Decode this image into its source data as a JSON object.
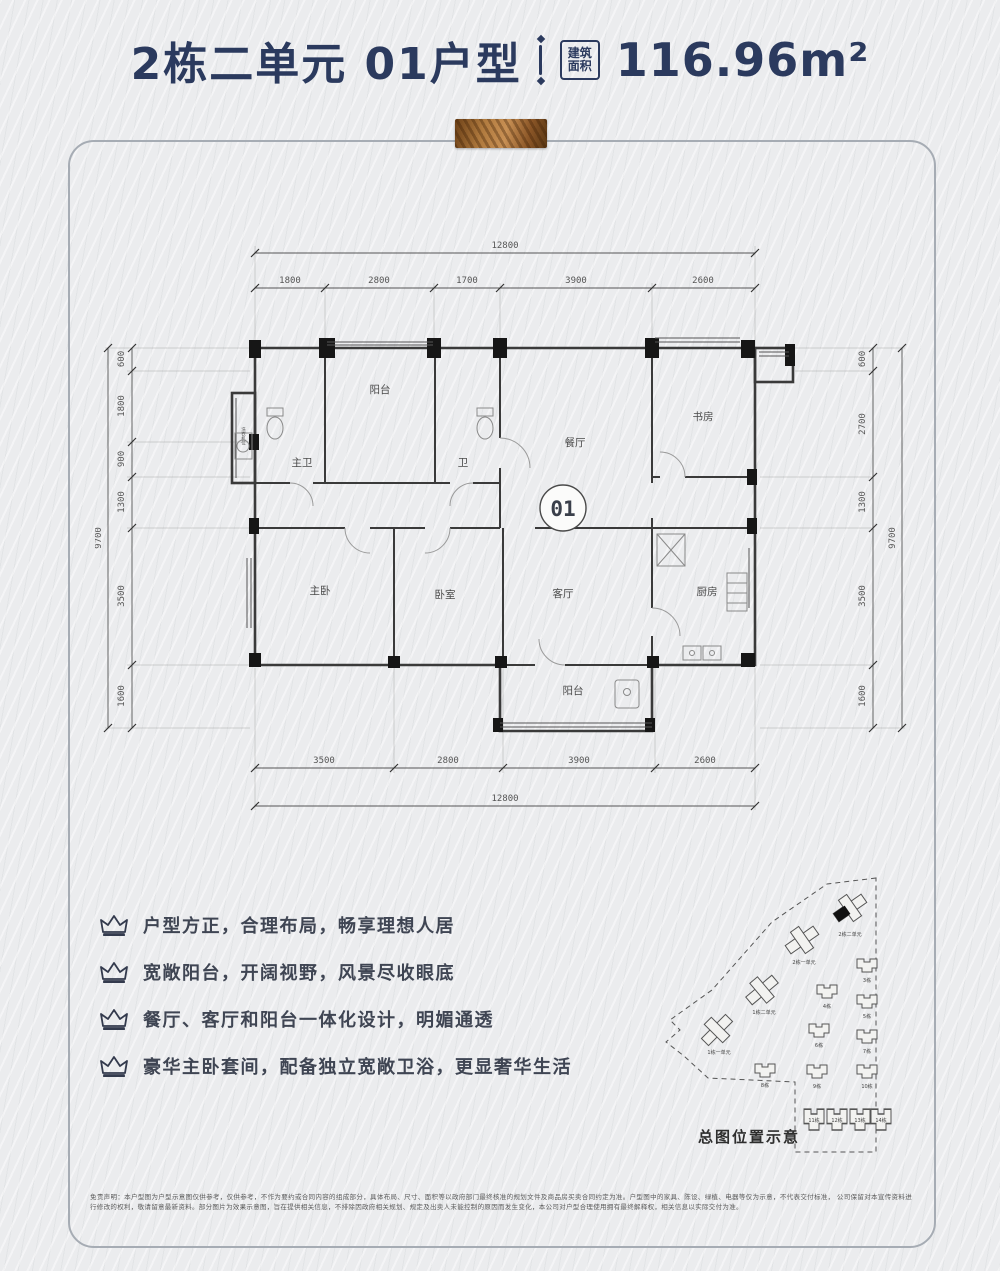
{
  "title": {
    "main": "2栋二单元 01户型",
    "area_badge_lines": [
      "建筑",
      "面积"
    ],
    "area_value": "116.96m²",
    "accent_color": "#2b3a5e"
  },
  "floorplan": {
    "unit_badge": "01",
    "rooms": {
      "balcony_top": "阳台",
      "master_bath": "主卫",
      "bath": "卫",
      "dining": "餐厅",
      "study": "书房",
      "master_bed": "主卧",
      "bedroom": "卧室",
      "living": "客厅",
      "kitchen": "厨房",
      "balcony_bottom": "阳台",
      "utility": "洗衣机位"
    },
    "dims": {
      "top": {
        "overall": "12800",
        "segments": [
          "1800",
          "2800",
          "1700",
          "3900",
          "2600"
        ]
      },
      "bottom": {
        "overall": "12800",
        "segments": [
          "3500",
          "2800",
          "3900",
          "2600"
        ]
      },
      "left": {
        "overall": "9700",
        "segments": [
          "600",
          "1800",
          "900",
          "1300",
          "3500",
          "1600"
        ]
      },
      "right": {
        "overall": "9700",
        "segments": [
          "600",
          "2700",
          "1300",
          "3500",
          "1600"
        ]
      }
    }
  },
  "features": [
    "户型方正，合理布局，畅享理想人居",
    "宽敞阳台，开阔视野，风景尽收眼底",
    "餐厅、客厅和阳台一体化设计，明媚通透",
    "豪华主卧套间，配备独立宽敞卫浴，更显奢华生活"
  ],
  "siteplan": {
    "caption": "总图位置示意",
    "buildings": [
      {
        "label": "2栋二单元",
        "highlight": true
      },
      {
        "label": "2栋一单元"
      },
      {
        "label": "1栋二单元"
      },
      {
        "label": "1栋一单元"
      },
      {
        "label": "3栋"
      },
      {
        "label": "4栋"
      },
      {
        "label": "5栋"
      },
      {
        "label": "6栋"
      },
      {
        "label": "7栋"
      },
      {
        "label": "8栋"
      },
      {
        "label": "9栋"
      },
      {
        "label": "10栋"
      },
      {
        "label": "11栋"
      },
      {
        "label": "12栋"
      },
      {
        "label": "13栋"
      },
      {
        "label": "14栋"
      }
    ]
  },
  "disclaimer": {
    "line1": "免责声明：本户型图为户型示意图仅供参考，仅供参考，不作为要约或合同内容的组成部分，具体布局、尺寸、面积等以政府部门最终核准的规划文件及商品房买卖合同约定为准。户型图中的家具、陈设、绿植、电器等仅为示意，不代表交付标准，",
    "line2": "公司保留对本宣传资料进行修改的权利，敬请留意最新资料。部分图片为效果示意图，旨在提供相关信息，不排除因政府相关规划、规定及出卖人未能控制的原因而发生变化，本公司对户型合理使用拥有最终解释权，相关信息以实际交付为准。"
  }
}
